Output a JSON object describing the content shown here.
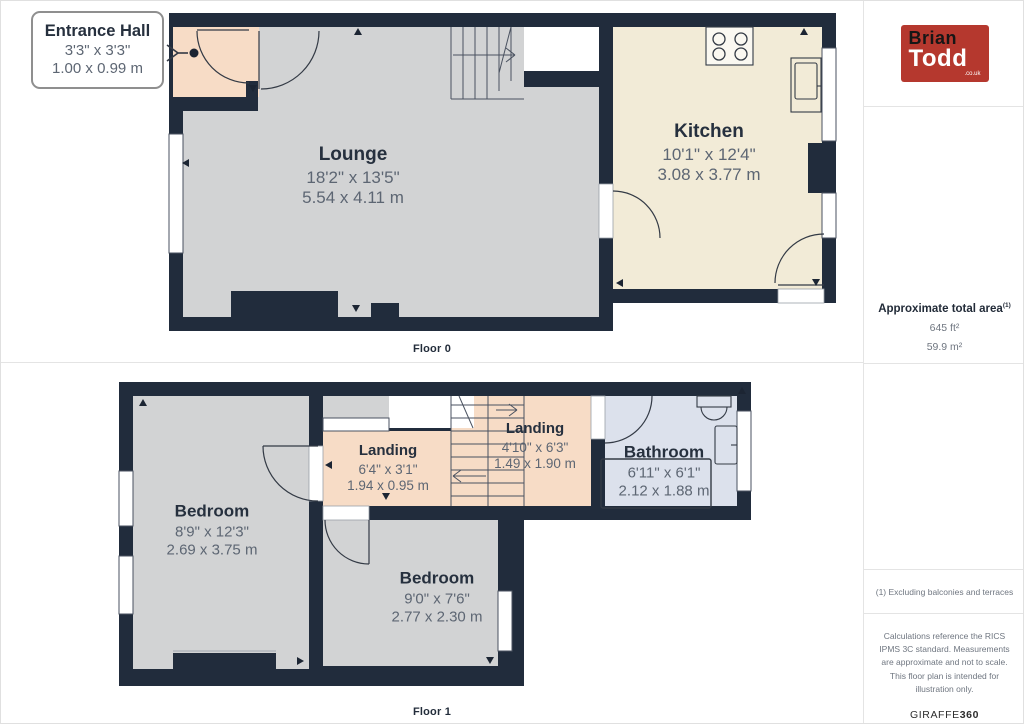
{
  "colors": {
    "wall": "#212c3c",
    "floor_gray": "#d2d3d4",
    "floor_cream": "#f2ebd7",
    "floor_peach": "#f7dcc6",
    "floor_blue": "#dce1ec",
    "logo_red": "#b5382e"
  },
  "floor0": {
    "label": "Floor 0",
    "callout": {
      "title": "Entrance Hall",
      "imperial": "3'3\" x 3'3\"",
      "metric": "1.00 x 0.99 m"
    },
    "rooms": {
      "lounge": {
        "name": "Lounge",
        "imperial": "18'2\" x 13'5\"",
        "metric": "5.54 x 4.11 m"
      },
      "kitchen": {
        "name": "Kitchen",
        "imperial": "10'1\" x 12'4\"",
        "metric": "3.08 x 3.77 m"
      }
    }
  },
  "floor1": {
    "label": "Floor 1",
    "rooms": {
      "bedroom1": {
        "name": "Bedroom",
        "imperial": "8'9\" x 12'3\"",
        "metric": "2.69 x 3.75 m"
      },
      "landing1": {
        "name": "Landing",
        "imperial": "6'4\" x 3'1\"",
        "metric": "1.94 x 0.95 m"
      },
      "landing2": {
        "name": "Landing",
        "imperial": "4'10\" x 6'3\"",
        "metric": "1.49 x 1.90 m"
      },
      "bathroom": {
        "name": "Bathroom",
        "imperial": "6'11\" x 6'1\"",
        "metric": "2.12 x 1.88 m"
      },
      "bedroom2": {
        "name": "Bedroom",
        "imperial": "9'0\" x 7'6\"",
        "metric": "2.77 x 2.30 m"
      }
    }
  },
  "sidebar": {
    "logo": {
      "line1": "Brian",
      "line2": "Todd",
      "suffix": ".co.uk"
    },
    "area": {
      "title": "Approximate total area",
      "footnote_ref": "(1)",
      "imperial": "645 ft²",
      "metric": "59.9 m²"
    },
    "footnote": "(1) Excluding balconies and terraces",
    "disclaimer": "Calculations reference the RICS IPMS 3C standard. Measurements are approximate and not to scale. This floor plan is intended for illustration only.",
    "brand": {
      "name": "GIRAFFE",
      "suffix": "360"
    }
  }
}
